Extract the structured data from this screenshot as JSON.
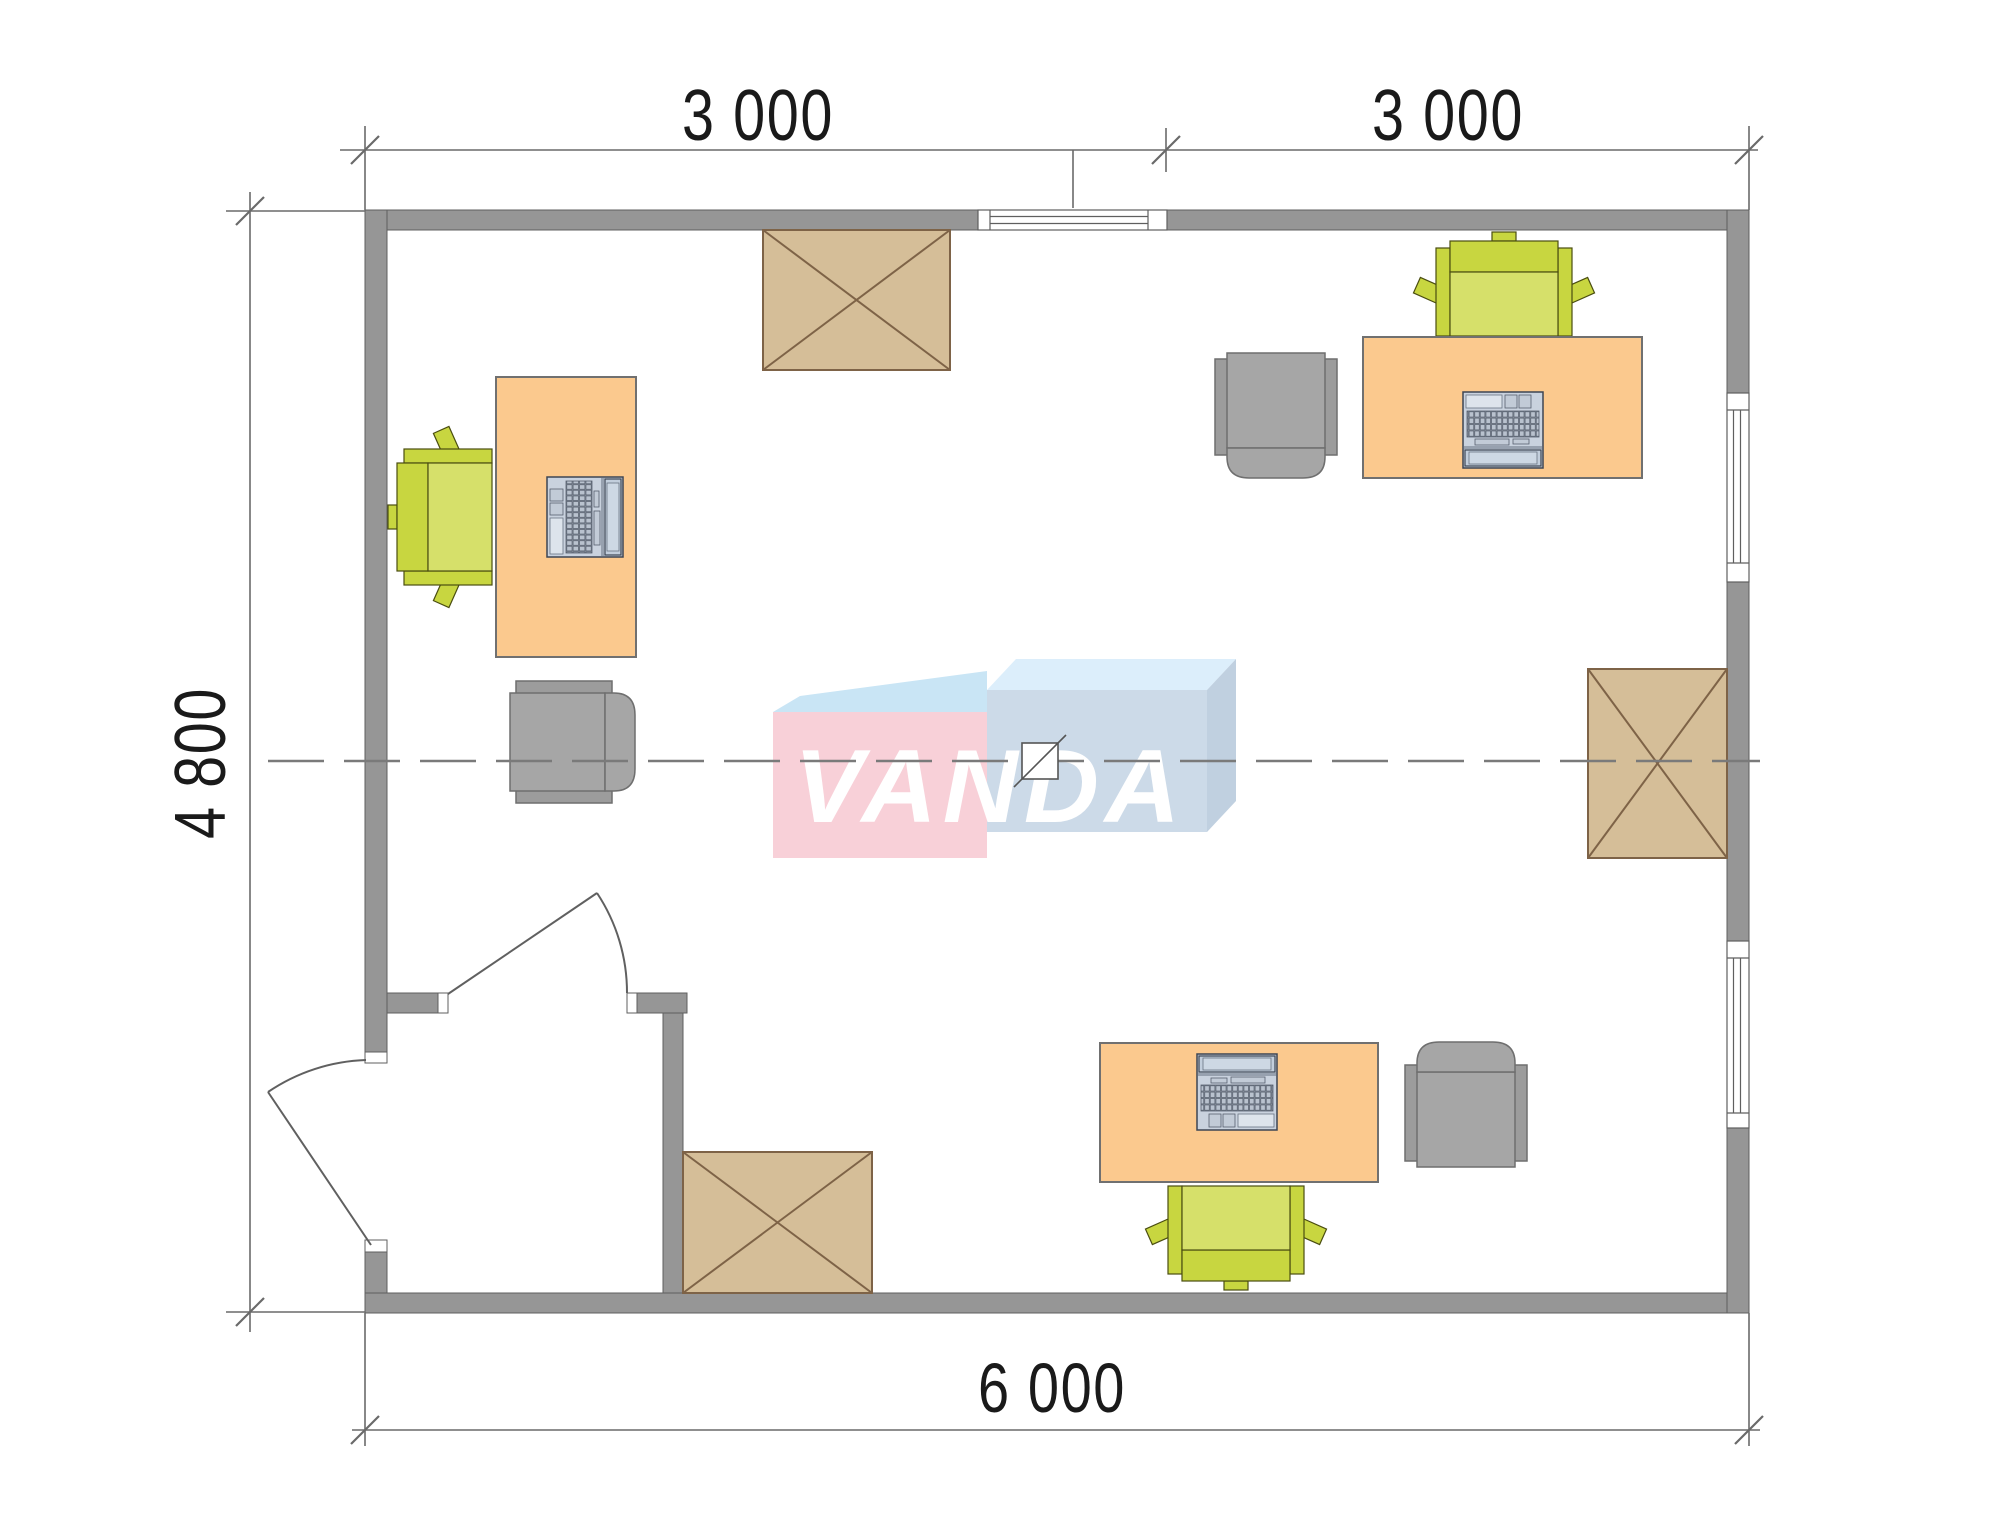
{
  "title": "Office floor plan with VANDA watermark",
  "dimensions": {
    "top_left": "3 000",
    "top_right": "3 000",
    "left": "4 800",
    "bottom": "6 000"
  },
  "watermark": {
    "text": "VANDA"
  },
  "colors": {
    "wall": "#969696",
    "wall-edge": "#5f5f5f",
    "desk": "#FBC98E",
    "desk-edge": "#707070",
    "xtable": "#D5BE98",
    "xtable-line": "#7E6347",
    "lime-dark": "#C8D640",
    "lime-light": "#D6E06A",
    "lime-edge": "#4a4d10",
    "chair": "#A6A6A6",
    "chair-side": "#9C9C9C",
    "chair-edge": "#6F6F6F",
    "laptop-body": "#C9D2DE",
    "laptop-screen": "#C2CEDC",
    "laptop-edge": "#3C4554",
    "dim-line": "#6A6A6A",
    "dim-text": "#1A1A1A",
    "door-line": "#606060",
    "axis-line": "#7A7A7A",
    "wm-pink": "#F8D0D8",
    "wm-blue-top": "#C9E5F5",
    "wm-blue-top2": "#DCEEFB",
    "wm-blue-front": "#CCDAE8",
    "wm-blue-side": "#C0D0E0",
    "wm-text": "#FFFFFF"
  }
}
